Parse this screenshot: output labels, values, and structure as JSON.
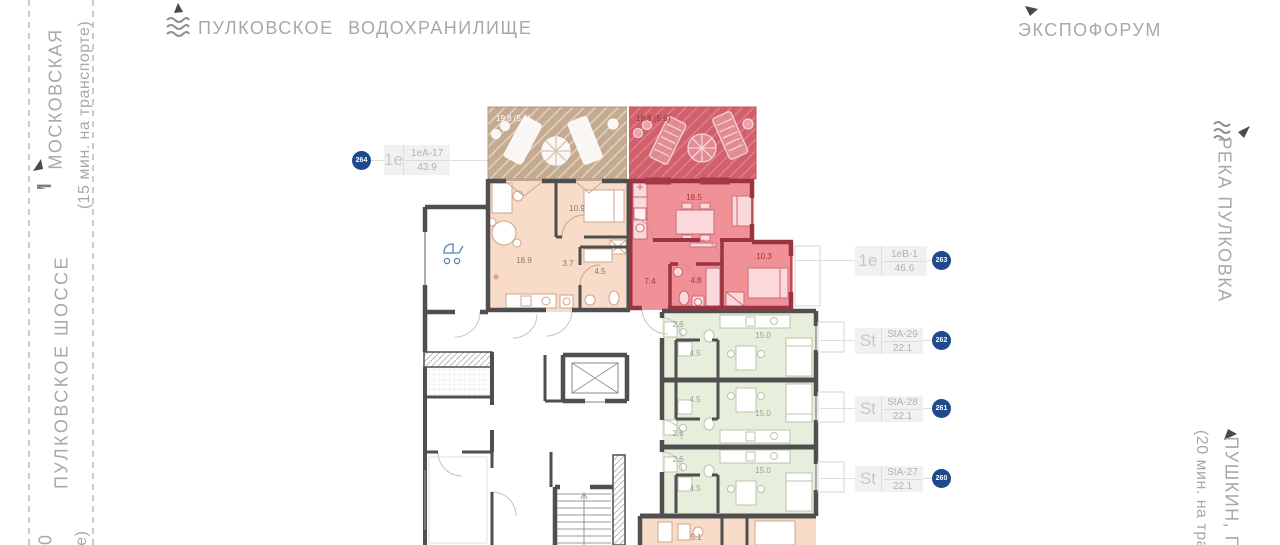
{
  "pois": {
    "reservoir": "ПУЛКОВСКОЕ ВОДОХРАНИЛИЩЕ",
    "expoforum": "ЭКСПОФОРУМ",
    "metro_letter": "М",
    "metro_name": "МОСКОВСКАЯ",
    "metro_time": "(15 мин. на транспорте)",
    "highway": "ПУЛКОВСКОЕ ШОССЕ",
    "river": "РЕКА ПУЛКОВКА",
    "pushkin_name": "ПУШКИН, ПА",
    "pushkin_time": "(20 мин. на тра",
    "frag_a": "30",
    "frag_b": "те)"
  },
  "units": [
    {
      "num": "264",
      "type": "1е",
      "code": "1еА-17",
      "area": "43.9"
    },
    {
      "num": "263",
      "type": "1е",
      "code": "1еВ-1",
      "area": "46.6"
    },
    {
      "num": "262",
      "type": "St",
      "code": "StA-29",
      "area": "22.1"
    },
    {
      "num": "261",
      "type": "St",
      "code": "StA-28",
      "area": "22.1"
    },
    {
      "num": "260",
      "type": "St",
      "code": "StA-27",
      "area": "22.1"
    }
  ],
  "plan": {
    "terrace_left": "19.8 (5.9)",
    "terrace_right": "18.6 (5.6)",
    "peach": {
      "living": "18.9",
      "bedroom": "10.9",
      "hall": "3.7",
      "bath": "4.5"
    },
    "red": {
      "living": "18.5",
      "bedroom": "10.3",
      "hall": "7.4",
      "bath": "4.8"
    },
    "studios": [
      {
        "hall": "2.6",
        "bath": "4.5",
        "room": "15.0"
      },
      {
        "hall": "2.6",
        "bath": "4.5",
        "room": "15.0"
      },
      {
        "hall": "2.6",
        "bath": "4.5",
        "room": "15.0"
      }
    ],
    "partial_room": "5.1"
  },
  "colors": {
    "badge_blue": "#1c4a8c",
    "apartment_peach": "#f8dcc9",
    "apartment_red": "#ef9197",
    "red_wall": "#9c3340",
    "studio_green": "#e7eedb",
    "terrace_tan": "#c4ab8f",
    "terrace_red": "#d2606c",
    "wall_gray": "#4f4f4f",
    "poi_text": "#a8a8a8"
  }
}
